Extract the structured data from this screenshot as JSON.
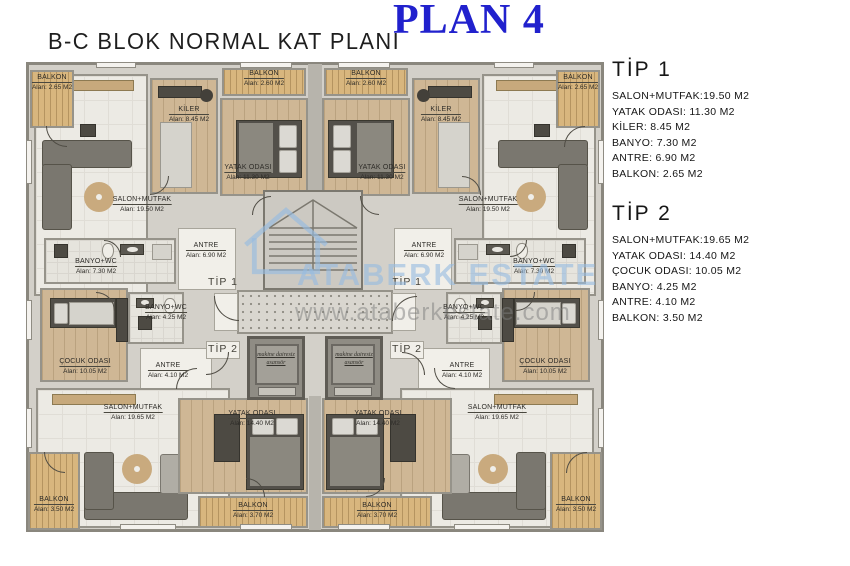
{
  "header": {
    "subtitle": "B-C BLOK NORMAL KAT PLANI",
    "title": "PLAN 4"
  },
  "legend": {
    "tip1": {
      "heading": "TİP 1",
      "lines": [
        "SALON+MUTFAK:19.50 M2",
        "YATAK ODASI: 11.30 M2",
        "KİLER: 8.45 M2",
        "BANYO: 7.30 M2",
        "ANTRE: 6.90 M2",
        "BALKON: 2.65 M2"
      ]
    },
    "tip2": {
      "heading": "TİP 2",
      "lines": [
        "SALON+MUTFAK:19.65 M2",
        "YATAK ODASI: 14.40 M2",
        "ÇOCUK ODASI: 10.05 M2",
        "BANYO: 4.25 M2",
        "ANTRE: 4.10 M2",
        "BALKON: 3.50 M2"
      ]
    }
  },
  "plan": {
    "rooms": {
      "salon_1950": {
        "name": "SALON+MUTFAK",
        "area": "Alan: 19.50 M2"
      },
      "salon_1965": {
        "name": "SALON+MUTFAK",
        "area": "Alan: 19.65 M2"
      },
      "yatak_1130": {
        "name": "YATAK ODASI",
        "area": "Alan: 11.30 M2"
      },
      "yatak_1440": {
        "name": "YATAK ODASI",
        "area": "Alan: 14.40 M2"
      },
      "kiler": {
        "name": "KİLER",
        "area": "Alan: 8.45 M2"
      },
      "banyo_730": {
        "name": "BANYO+WC",
        "area": "Alan: 7.30 M2"
      },
      "banyo_425": {
        "name": "BANYO+WC",
        "area": "Alan: 4.25 M2"
      },
      "antre_690": {
        "name": "ANTRE",
        "area": "Alan: 6.90 M2"
      },
      "antre_410": {
        "name": "ANTRE",
        "area": "Alan: 4.10 M2"
      },
      "cocuk": {
        "name": "ÇOCUK ODASI",
        "area": "Alan: 10.05 M2"
      },
      "balkon_265": {
        "name": "BALKON",
        "area": "Alan: 2.65 M2"
      },
      "balkon_260": {
        "name": "BALKON",
        "area": "Alan: 2.60 M2"
      },
      "balkon_350": {
        "name": "BALKON",
        "area": "Alan: 3.50 M2"
      },
      "balkon_370": {
        "name": "BALKON",
        "area": "Alan: 3.70 M2"
      }
    },
    "unit_labels": {
      "tip1": "TİP 1",
      "tip2": "TİP 2"
    },
    "elevator": {
      "line1": "makine dairesiz",
      "line2": "asansör"
    }
  },
  "watermark": {
    "brand": "ATABERK ESTATE",
    "url": "www.ataberkestate.com"
  },
  "colors": {
    "title_blue": "#2121cd",
    "watermark_blue": "#96bce0",
    "balcony_wood": "#d8b67e",
    "room_wood": "#cfb795",
    "wall_gray": "#8a877e"
  }
}
